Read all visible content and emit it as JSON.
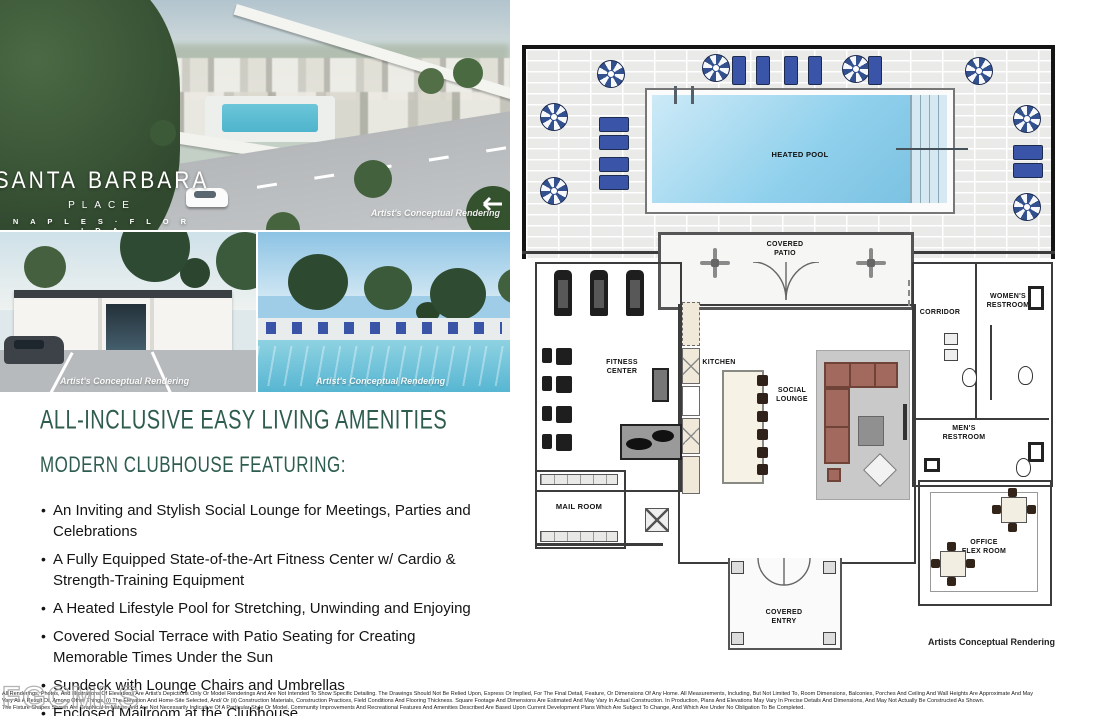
{
  "hero": {
    "brand_left": "SANTA",
    "brand_right": "BARBARA",
    "brand_sub": "PLACE",
    "brand_location": "N A P L E S · F L O R I D A",
    "caption": "Artist's Conceptual Rendering"
  },
  "photos": {
    "left_caption": "Artist's Conceptual Rendering",
    "right_caption": "Artist's Conceptual Rendering"
  },
  "amenities": {
    "title": "ALL-INCLUSIVE EASY LIVING AMENITIES",
    "subtitle": "MODERN CLUBHOUSE FEATURING:",
    "items": [
      "An Inviting and Stylish Social Lounge for Meetings, Parties and Celebrations",
      "A Fully Equipped State-of-the-Art Fitness Center w/ Cardio & Strength-Training Equipment",
      "A Heated Lifestyle Pool for Stretching, Unwinding and Enjoying",
      "Covered Social Terrace with Patio Seating for Creating Memorable Times Under the Sun",
      "Sundeck with Lounge Chairs and Umbrellas",
      "Enclosed Mailroom at the Clubhouse"
    ]
  },
  "floorplan": {
    "rooms": {
      "heated_pool": "HEATED POOL",
      "covered_patio": "COVERED\nPATIO",
      "fitness_center": "FITNESS\nCENTER",
      "kitchen": "KITCHEN",
      "social_lounge": "SOCIAL\nLOUNGE",
      "corridor": "CORRIDOR",
      "womens_restroom": "WOMEN'S\nRESTROOM",
      "mens_restroom": "MEN'S\nRESTROOM",
      "mail_room": "MAIL ROOM",
      "office_flex_room": "OFFICE\nFLEX ROOM",
      "covered_entry": "COVERED\nENTRY"
    },
    "caption": "Artists Conceptual Rendering"
  },
  "footer": {
    "watermark": "FGCMLS",
    "disclaimer_lines": [
      "All Renderings, Photos, And Illustrations Of Elevations Are Artist's Depictions Only Or Model Renderings And Are Not Intended To Show Specific Detailing. The Drawings Should Not Be Relied Upon, Express Or Implied, For The Final Detail, Feature, Or Dimensions Of Any Home. All Measurements, Including, But Not Limited To, Room Dimensions, Balconies, Porches And Ceiling And Wall Heights Are Approximate And May",
      "Vary As A Result Of, Among Other Things, (i) The Elevation And Home-Site Selected, And/ Or (ii) Construction Materials, Construction Practices, Field Conditions And Flooring Thickness. Square Footage And Dimensions Are Estimated And May Vary In Actual Construction. In Production, Plans And Elevations May Vary In Precise Details And Dimensions, And May Not Actually Be Constructed As Shown.",
      "The Fixture Shapes Shown Are Graphical In Nature And Are Not Necessarily Indicative Of A Particular Style Or Model. Community Improvements And Recreational Features And Amenities Described Are Based Upon Current Development Plans Which Are Subject To Change, And Which Are Under No Obligation To Be Completed."
    ]
  },
  "colors": {
    "heading_green": "#2e5c4e",
    "umbrella_blue": "#33508f",
    "lounger_blue": "#3a55a8",
    "pool_blue": "#8fd0ec",
    "sofa_brown": "#a26a5e"
  }
}
